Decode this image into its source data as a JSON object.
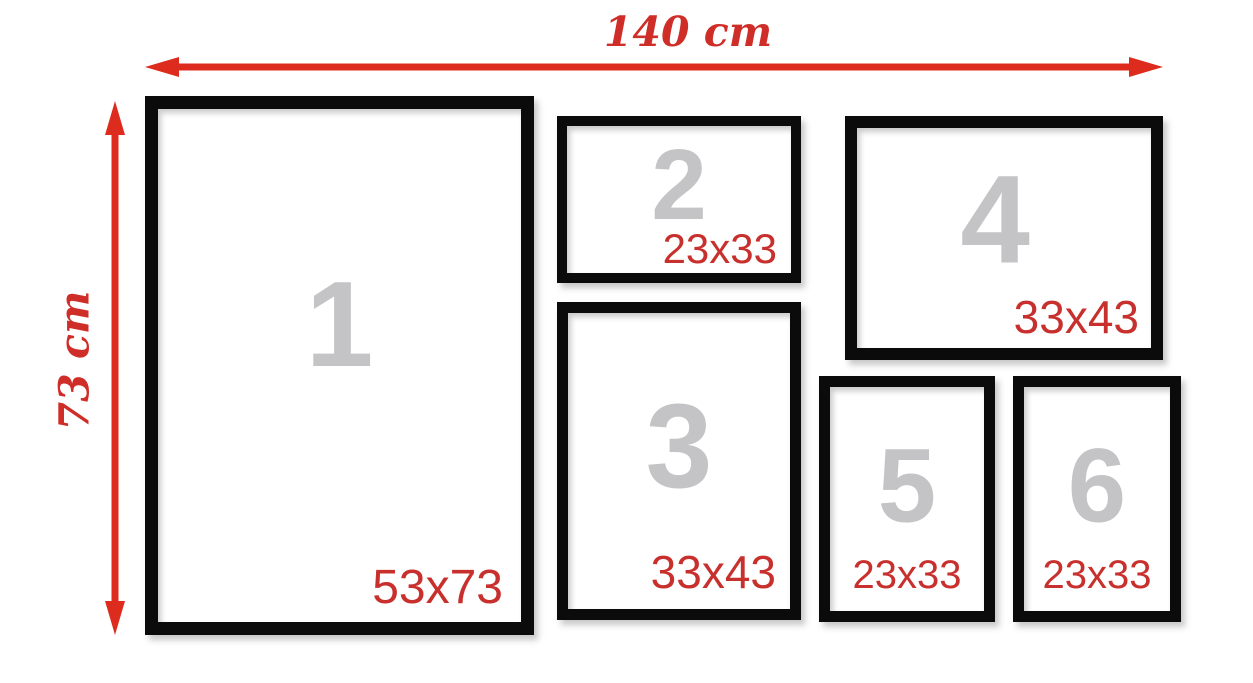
{
  "diagram": {
    "width_label": "140 cm",
    "height_label": "73 cm"
  },
  "frames": [
    {
      "number": "1",
      "size": "53x73"
    },
    {
      "number": "2",
      "size": "23x33"
    },
    {
      "number": "3",
      "size": "33x43"
    },
    {
      "number": "4",
      "size": "33x43"
    },
    {
      "number": "5",
      "size": "23x33"
    },
    {
      "number": "6",
      "size": "23x33"
    }
  ],
  "colors": {
    "arrow_red": "#dd2b1e",
    "dimension_text_red": "#cf2e28",
    "size_text_red": "#c7302d",
    "digit_gray": "#c4c4c6",
    "frame_black": "#0b0b0b",
    "background": "#ffffff"
  }
}
